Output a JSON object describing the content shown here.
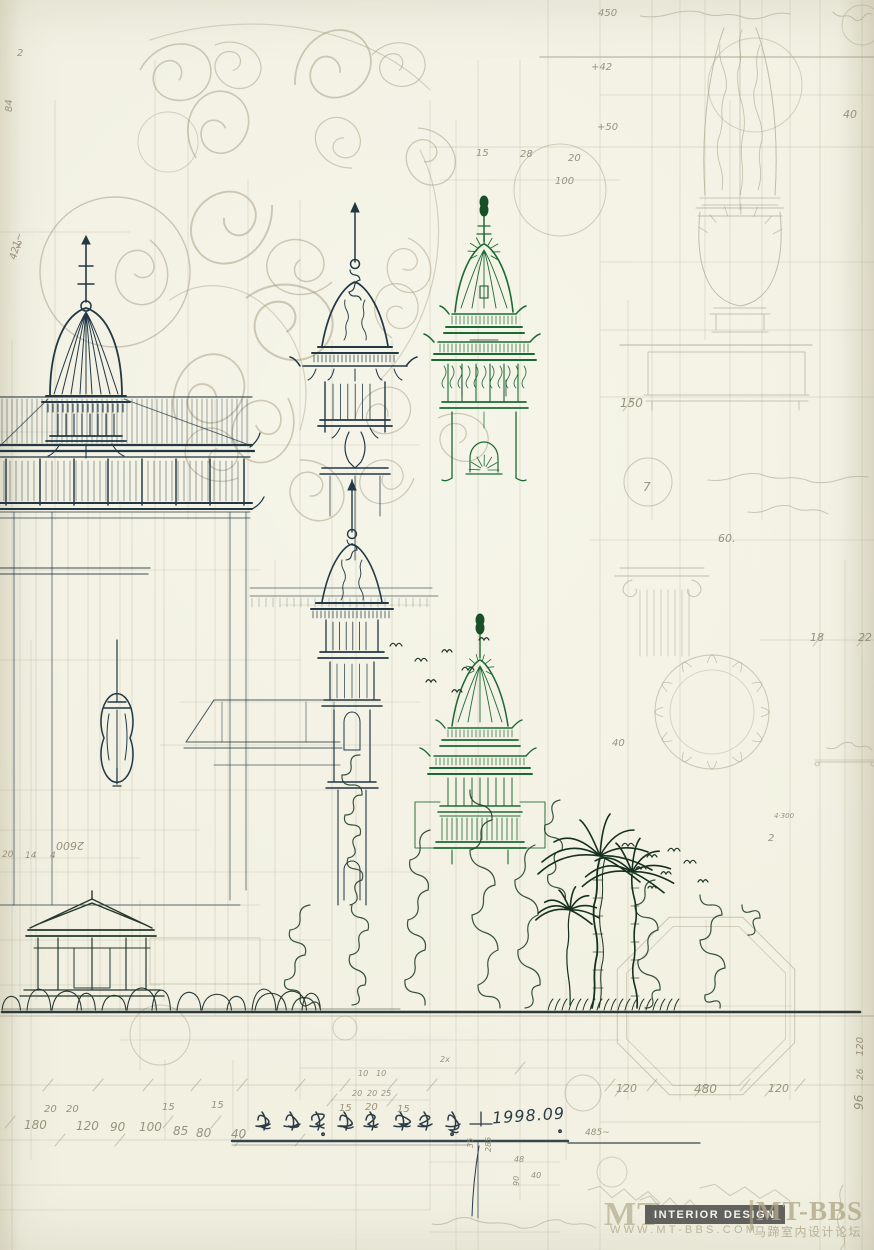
{
  "title_block": {
    "text": "伯·米柯湾 立面方案",
    "date": "1998.09"
  },
  "watermark": {
    "mt": "MT",
    "badge": "INTERIOR DESIGN",
    "divider": "|",
    "brand": "MT-BBS",
    "url": "WWW.MT-BBS.COM",
    "forum": "马蹄室内设计论坛"
  },
  "palette": {
    "paper": "#f0efe0",
    "pencil": "#a09a80",
    "ink_blue": "#223844",
    "ink_green": "#1c6a33",
    "badge_bg": "#565654",
    "watermark_beige": "#b0a884"
  },
  "scene_objects": [
    "domed-pavilion-elevation",
    "spire-tower-sketch",
    "pagoda-tower-sketch",
    "bell-tower-sketch",
    "green-pagoda-sketch",
    "garden-gate-pavilion",
    "palm-trees",
    "shrub-outlines",
    "flying-birds",
    "ground-line",
    "urn-finial-study",
    "planter-study",
    "column-capital-study",
    "octagonal-plan-study",
    "ornamental-scroll-pattern",
    "hand-lettered-title"
  ],
  "annotations": [
    {
      "t": "450",
      "x": 598,
      "y": 8
    },
    {
      "t": "+42",
      "x": 591,
      "y": 62
    },
    {
      "t": "+50",
      "x": 597,
      "y": 122
    },
    {
      "t": "40",
      "x": 843,
      "y": 108,
      "s": 11
    },
    {
      "t": "15",
      "x": 476,
      "y": 148
    },
    {
      "t": "28",
      "x": 520,
      "y": 149
    },
    {
      "t": "20",
      "x": 568,
      "y": 153
    },
    {
      "t": "100",
      "x": 555,
      "y": 176
    },
    {
      "t": "2",
      "x": 17,
      "y": 48
    },
    {
      "t": "84",
      "x": 4,
      "y": 112,
      "r": -90
    },
    {
      "t": "2",
      "x": 16,
      "y": 240
    },
    {
      "t": "421~",
      "x": 8,
      "y": 258,
      "r": -75
    },
    {
      "t": "150",
      "x": 620,
      "y": 396,
      "s": 12
    },
    {
      "t": "7",
      "x": 643,
      "y": 480,
      "s": 12
    },
    {
      "t": "60.",
      "x": 718,
      "y": 532,
      "s": 11
    },
    {
      "t": "18",
      "x": 810,
      "y": 631,
      "s": 11
    },
    {
      "t": "22",
      "x": 858,
      "y": 631,
      "s": 11
    },
    {
      "t": "40",
      "x": 612,
      "y": 738
    },
    {
      "t": "4·300",
      "x": 774,
      "y": 812,
      "s": 7
    },
    {
      "t": "2",
      "x": 768,
      "y": 833
    },
    {
      "t": "20",
      "x": 2,
      "y": 850,
      "s": 9
    },
    {
      "t": "14",
      "x": 25,
      "y": 851,
      "s": 9
    },
    {
      "t": "4",
      "x": 50,
      "y": 851,
      "s": 9
    },
    {
      "t": "2600",
      "x": 84,
      "y": 852,
      "r": 180,
      "s": 11
    },
    {
      "t": "20",
      "x": 44,
      "y": 1104
    },
    {
      "t": "20",
      "x": 66,
      "y": 1104
    },
    {
      "t": "15",
      "x": 162,
      "y": 1102
    },
    {
      "t": "15",
      "x": 211,
      "y": 1100
    },
    {
      "t": "180",
      "x": 24,
      "y": 1118,
      "s": 12
    },
    {
      "t": "120",
      "x": 76,
      "y": 1119,
      "s": 12
    },
    {
      "t": "90",
      "x": 110,
      "y": 1120,
      "s": 12
    },
    {
      "t": "100",
      "x": 139,
      "y": 1120,
      "s": 12
    },
    {
      "t": "85",
      "x": 173,
      "y": 1124,
      "s": 12
    },
    {
      "t": "80",
      "x": 196,
      "y": 1126,
      "s": 12
    },
    {
      "t": "40",
      "x": 231,
      "y": 1127,
      "s": 12
    },
    {
      "t": "10",
      "x": 358,
      "y": 1069,
      "s": 8
    },
    {
      "t": "10",
      "x": 376,
      "y": 1069,
      "s": 8
    },
    {
      "t": "20",
      "x": 352,
      "y": 1089,
      "s": 8
    },
    {
      "t": "20",
      "x": 367,
      "y": 1089,
      "s": 8
    },
    {
      "t": "25",
      "x": 381,
      "y": 1089,
      "s": 8
    },
    {
      "t": "15",
      "x": 339,
      "y": 1103
    },
    {
      "t": "20",
      "x": 365,
      "y": 1102
    },
    {
      "t": "15",
      "x": 397,
      "y": 1104
    },
    {
      "t": "2x",
      "x": 440,
      "y": 1055,
      "s": 8
    },
    {
      "t": "120",
      "x": 616,
      "y": 1082,
      "s": 11
    },
    {
      "t": "480",
      "x": 694,
      "y": 1082,
      "s": 12
    },
    {
      "t": "120",
      "x": 768,
      "y": 1082,
      "s": 11
    },
    {
      "t": "120",
      "x": 855,
      "y": 1056,
      "r": -90,
      "s": 10
    },
    {
      "t": "26",
      "x": 856,
      "y": 1080,
      "r": -90,
      "s": 9
    },
    {
      "t": "96",
      "x": 852,
      "y": 1110,
      "r": -90,
      "s": 12
    },
    {
      "t": "285",
      "x": 484,
      "y": 1152,
      "r": -90,
      "s": 8
    },
    {
      "t": "35",
      "x": 466,
      "y": 1148,
      "r": -90,
      "s": 8
    },
    {
      "t": "48",
      "x": 514,
      "y": 1155,
      "s": 8
    },
    {
      "t": "40",
      "x": 531,
      "y": 1171,
      "s": 8
    },
    {
      "t": "90",
      "x": 512,
      "y": 1186,
      "r": -90,
      "s": 8
    },
    {
      "t": "485~",
      "x": 585,
      "y": 1128,
      "s": 9
    }
  ]
}
